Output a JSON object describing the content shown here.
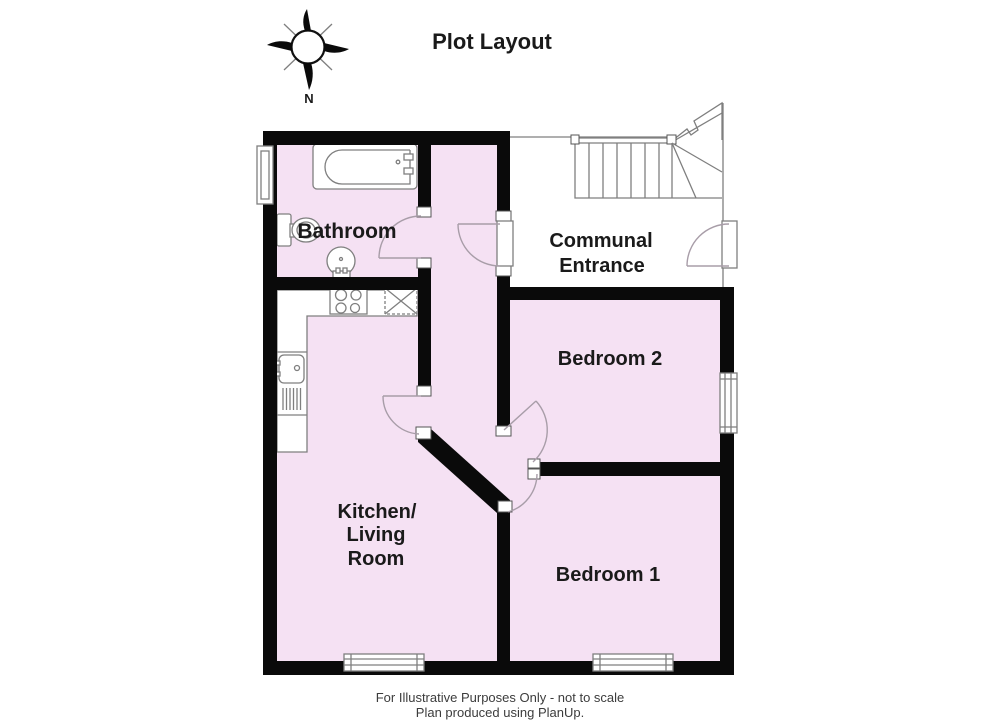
{
  "title": "Plot Layout",
  "compass": {
    "north_label": "N"
  },
  "rooms": {
    "bathroom": "Bathroom",
    "communal_entrance_line1": "Communal",
    "communal_entrance_line2": "Entrance",
    "bedroom2": "Bedroom 2",
    "bedroom1": "Bedroom 1",
    "kitchen_line1": "Kitchen/",
    "kitchen_line2": "Living",
    "kitchen_line3": "Room"
  },
  "footer": {
    "line1": "For Illustrative Purposes Only - not to scale",
    "line2": "Plan produced using PlanUp."
  },
  "colors": {
    "room_fill": "#f5e1f3",
    "wall": "#0a0a0a",
    "line": "#7f7f7f",
    "arc": "#a89da8",
    "text": "#1a1a1a"
  }
}
